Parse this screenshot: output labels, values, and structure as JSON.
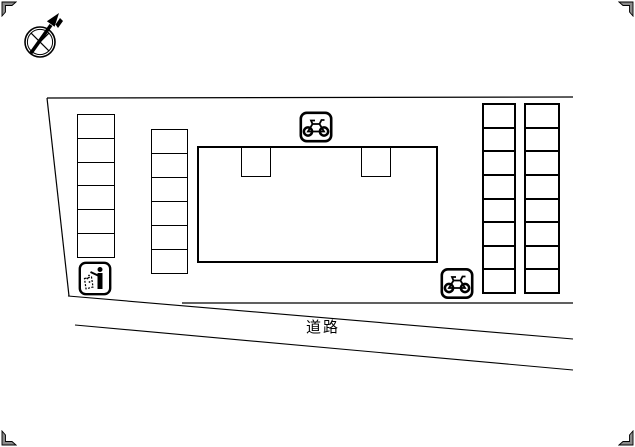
{
  "page": {
    "width": 635,
    "height": 447,
    "background_color": "#ffffff",
    "line_color": "#000000"
  },
  "drawing_type": "site-plan",
  "compass": {
    "icon": "north-compass-arrow-icon",
    "direction": "north-east"
  },
  "road": {
    "label": "道路"
  },
  "parking": {
    "columns": [
      {
        "id": "left",
        "spaces": 6
      },
      {
        "id": "middle",
        "spaces": 6
      },
      {
        "id": "right-inner",
        "spaces": 8
      },
      {
        "id": "right-outer",
        "spaces": 8
      }
    ]
  },
  "building": {
    "entrance_notches": 2
  },
  "icons": {
    "bicycle_top": "bicycle-parking-icon",
    "bicycle_right": "bicycle-parking-icon",
    "garbage": "garbage-disposal-icon",
    "corner_marks": "corner-registration-mark"
  }
}
